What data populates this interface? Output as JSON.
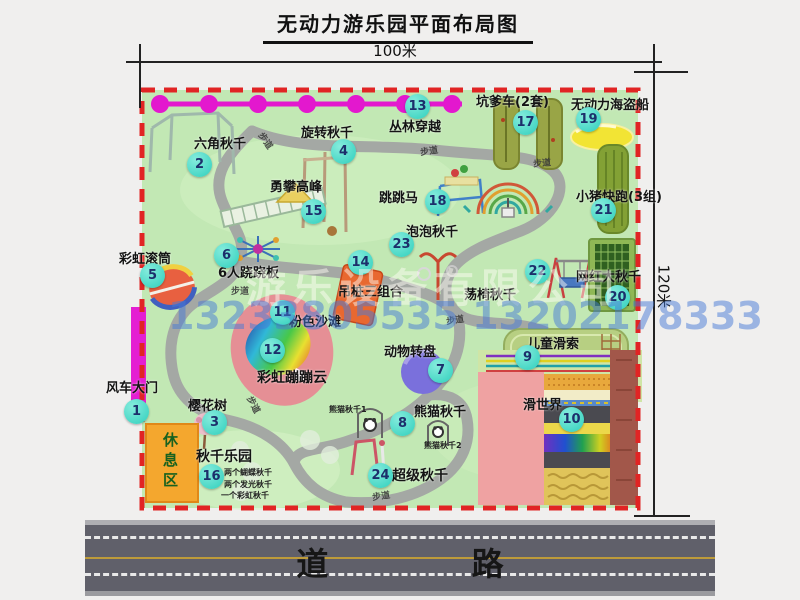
{
  "title": "无动力游乐园平面布局图",
  "dimensions": {
    "width": "100米",
    "height": "120米"
  },
  "road_label": "道 路",
  "watermark": {
    "company": "游乐设备有限公司",
    "phone": "13233805535 13202178333"
  },
  "rest_area": "休息区",
  "path_label": "步道",
  "annotations": {
    "panda1": "熊猫秋千1",
    "panda2": "熊猫秋千2"
  },
  "swing_park_details": [
    "两个蝴蝶秋千",
    "两个发光秋千",
    "一个彩虹秋千"
  ],
  "items": [
    {
      "num": "1",
      "label": "风车大门"
    },
    {
      "num": "2",
      "label": "六角秋千"
    },
    {
      "num": "3",
      "label": "樱花树"
    },
    {
      "num": "4",
      "label": "旋转秋千"
    },
    {
      "num": "5",
      "label": "彩虹滚筒"
    },
    {
      "num": "6",
      "label": "6人跷跷板"
    },
    {
      "num": "7",
      "label": "动物转盘"
    },
    {
      "num": "8",
      "label": "熊猫秋千"
    },
    {
      "num": "9",
      "label": "儿童滑索"
    },
    {
      "num": "10",
      "label": "滑世界"
    },
    {
      "num": "11",
      "label": "粉色沙滩"
    },
    {
      "num": "12",
      "label": "彩虹蹦蹦云"
    },
    {
      "num": "13",
      "label": "丛林穿越"
    },
    {
      "num": "14",
      "label": "吊桩三组合"
    },
    {
      "num": "15",
      "label": "勇攀高峰"
    },
    {
      "num": "16",
      "label": "秋千乐园"
    },
    {
      "num": "17",
      "label": "坑爹车(2套)"
    },
    {
      "num": "18",
      "label": "跳跳马"
    },
    {
      "num": "19",
      "label": "无动力海盗船"
    },
    {
      "num": "20",
      "label": "网红大秋千"
    },
    {
      "num": "21",
      "label": "小猪快跑(3组)"
    },
    {
      "num": "22",
      "label": "荡椅秋千"
    },
    {
      "num": "23",
      "label": "泡泡秋千"
    },
    {
      "num": "24",
      "label": "超级秋千"
    }
  ],
  "colors": {
    "map_green": "#c2e8b4",
    "border_red": "#e12424",
    "badge_teal": "#2fcfbc",
    "zipline_magenta": "#e318ce",
    "road_gray": "#60606a",
    "beach_pink": "#e58f95",
    "rest_area_orange": "#f4a72e"
  }
}
